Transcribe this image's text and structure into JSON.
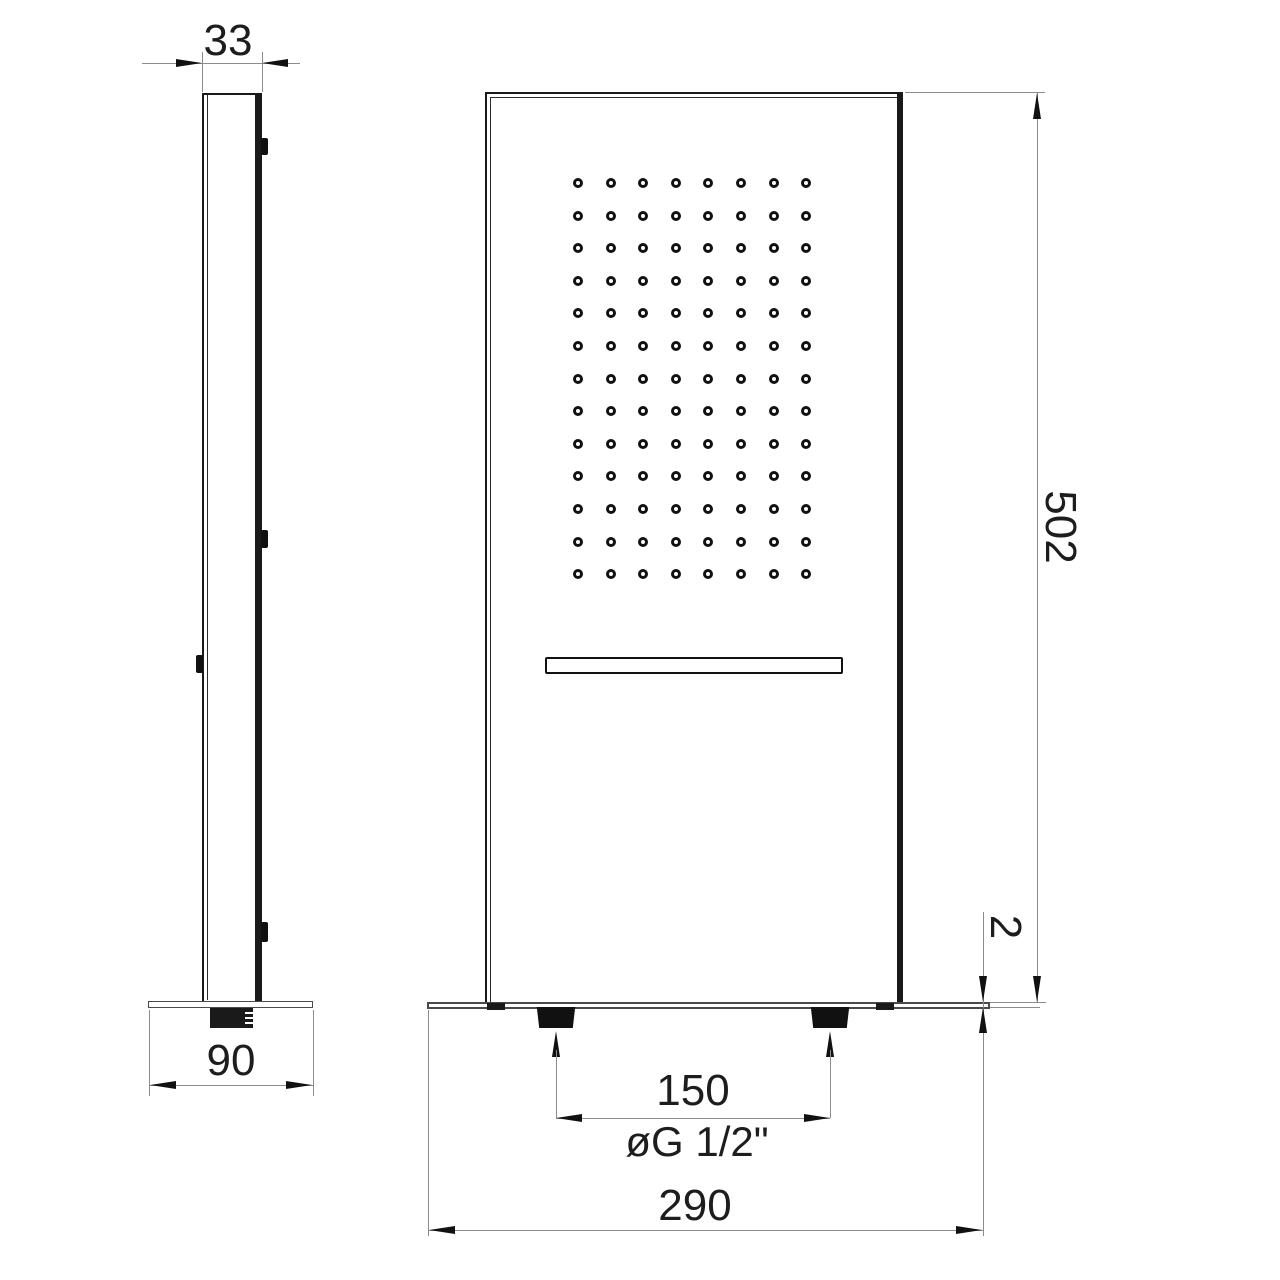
{
  "page": {
    "background": "#ffffff",
    "line_color": "#1a1a1a",
    "dim_line_color": "#8c8c8c",
    "text_color": "#1d1d1d"
  },
  "drawing": {
    "type": "technical-drawing",
    "subject": "wall-mounted shower panel, orthographic side and front views with dimensions",
    "side": {
      "depth": "33",
      "base_width": "90",
      "mount_tab_count_right": 3,
      "mount_tab_count_left": 1
    },
    "front": {
      "height": "502",
      "plate_thickness": "2",
      "inlet_spacing": "150",
      "thread": "øG 1/2\"",
      "width": "290",
      "inlet_count": 2,
      "nozzle_grid": {
        "rows": 13,
        "columns": 8
      }
    }
  }
}
